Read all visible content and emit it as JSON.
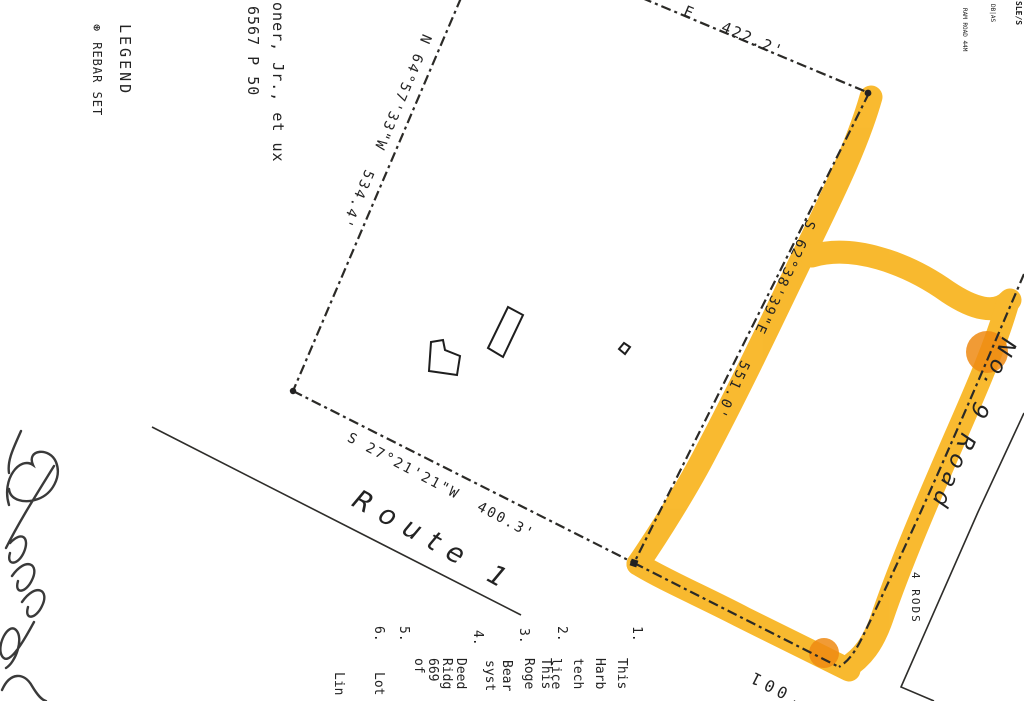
{
  "colors": {
    "highlight": "#F8B41E",
    "highlight_overlap": "#EE8A12",
    "ink": "#232323"
  },
  "legend": {
    "title": "LEGEND",
    "rebar_symbol": "⊛",
    "rebar_label": "REBAR SET"
  },
  "adjoiner": {
    "name_fragment": "ooner, Jr., et ux",
    "deed_fragment": "6567 P 50"
  },
  "corner_stamp": {
    "frag1": "SLE/S",
    "frag2": "DB|AS",
    "frag3": "RAM ROAD",
    "frag4": "44M"
  },
  "boundaries": {
    "north": {
      "bearing_fragment": "E",
      "distance": "422.2'"
    },
    "west": {
      "bearing": "N 64°57'33\"W",
      "distance": "534.4'"
    },
    "east": {
      "bearing": "S 62°38'39\"E",
      "distance": "551.0'"
    },
    "south": {
      "bearing": "S 27°21'21\"W",
      "distance": "400.3'"
    },
    "southeast_distance": "100'"
  },
  "roads": {
    "route1": "Route 1",
    "no9_name": "No. 9 Road",
    "no9_width": "4 RODS"
  },
  "notes": [
    {
      "num": "1.",
      "l0": "This",
      "l1": "Harb",
      "l2": "tech",
      "l3": "lice"
    },
    {
      "num": "2.",
      "l0": "This",
      "l1": "Roge"
    },
    {
      "num": "3.",
      "l0": "Bear",
      "l1": "syst"
    },
    {
      "num": "4.",
      "l0": "Deed",
      "l1": "Ridg",
      "l2": "669",
      "l3": "of"
    },
    {
      "num": "5.",
      "l0": "Lot"
    },
    {
      "num": "6.",
      "l0": "Lin"
    }
  ]
}
